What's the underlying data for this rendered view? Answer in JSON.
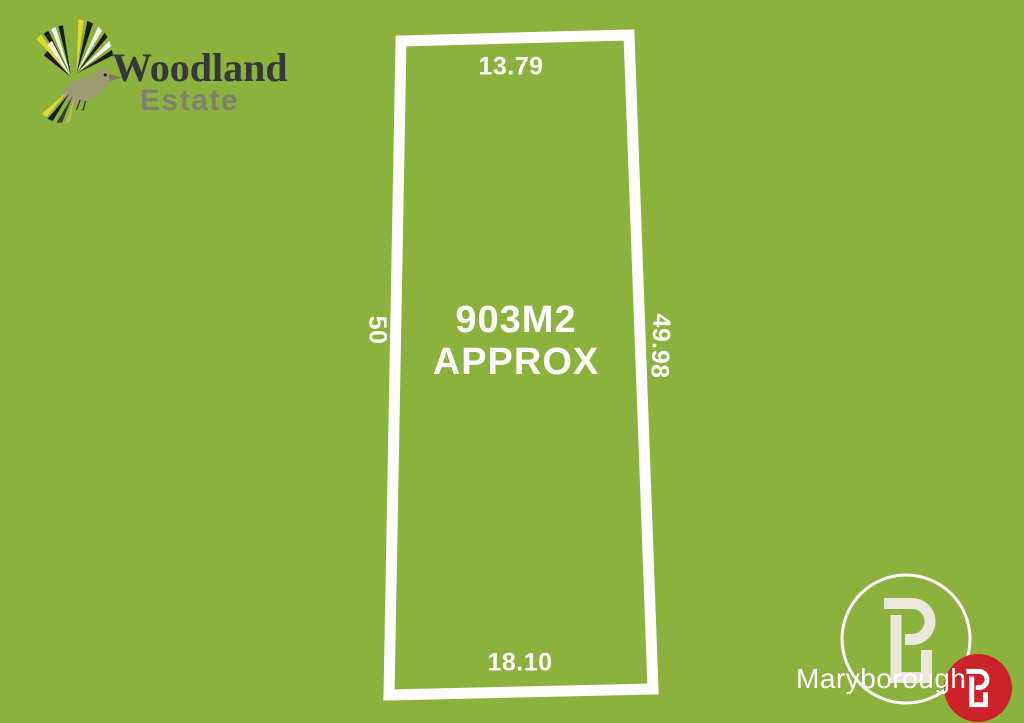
{
  "colors": {
    "background": "#8bb23c",
    "boundary": "#ffffff",
    "label_text": "#ffffff",
    "woodland_text": "#35373a",
    "estate_text": "#7d816e",
    "agency_text": "#ffffff",
    "b_mark_cream": "#e9e8da",
    "badge_red": "#cb2329",
    "bird_yellow": "#dfd832",
    "bird_body": "#9b9c72",
    "bird_dark": "#1d1d18",
    "bird_white": "#f2f2ee"
  },
  "estate_logo": {
    "name_line1": "Woodland",
    "name_line2": "Estate"
  },
  "lot": {
    "area": {
      "line1": "903M2",
      "line2": "APPROX"
    },
    "dimensions": {
      "top": "13.79",
      "right": "49.98",
      "bottom": "18.10",
      "left": "50"
    }
  },
  "agency": {
    "name": "Maryborough"
  },
  "icons": {
    "bird": "bird-icon",
    "b_mark": "b-mark-icon",
    "b_badge": "b-badge-icon"
  }
}
